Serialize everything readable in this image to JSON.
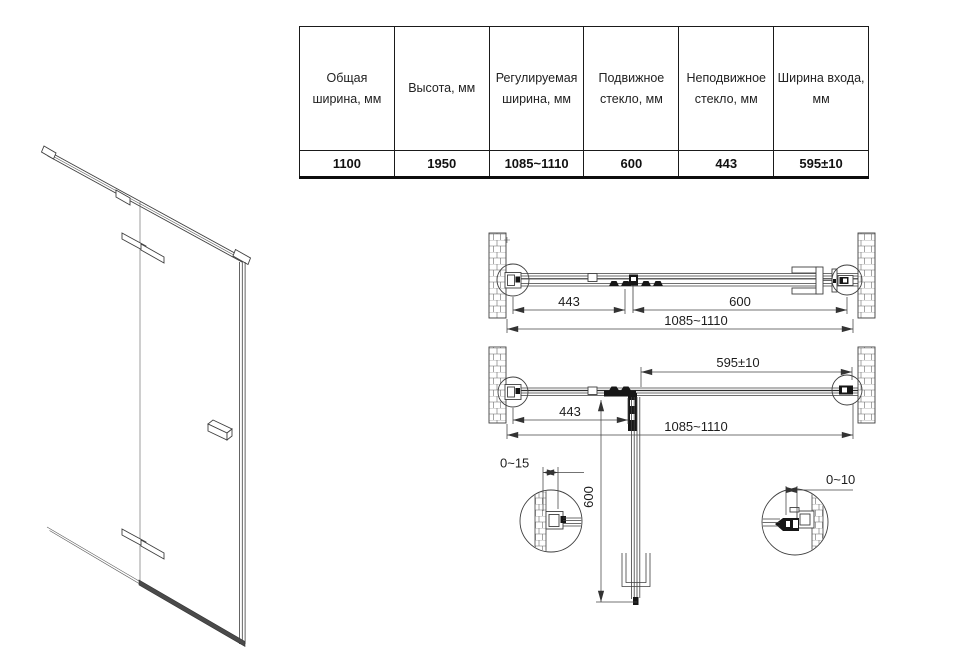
{
  "table": {
    "columns": [
      {
        "header": "Общая ширина, мм",
        "value": "1100"
      },
      {
        "header": "Высота, мм",
        "value": "1950"
      },
      {
        "header": "Регулируемая ширина, мм",
        "value": "1085~1110"
      },
      {
        "header": "Подвижное стекло, мм",
        "value": "600"
      },
      {
        "header": "Неподвижное стекло, мм",
        "value": "443"
      },
      {
        "header": "Ширина входа, мм",
        "value": "595±10"
      }
    ]
  },
  "drawings": {
    "top_view_closed": {
      "dim_fixed_glass": "443",
      "dim_movable_glass": "600",
      "dim_overall_width": "1085~1110"
    },
    "top_view_open": {
      "dim_entry_width": "595±10",
      "dim_fixed_glass": "443",
      "dim_overall_width": "1085~1110",
      "dim_door_length": "600"
    },
    "details": {
      "dim_wall_profile_left_adjust": "0~15",
      "dim_wall_profile_right_adjust": "0~10"
    }
  },
  "colors": {
    "line": "#3f3f3f",
    "dark": "#161616",
    "text": "#1d1d1d",
    "table_border": "#1a1a1a"
  }
}
